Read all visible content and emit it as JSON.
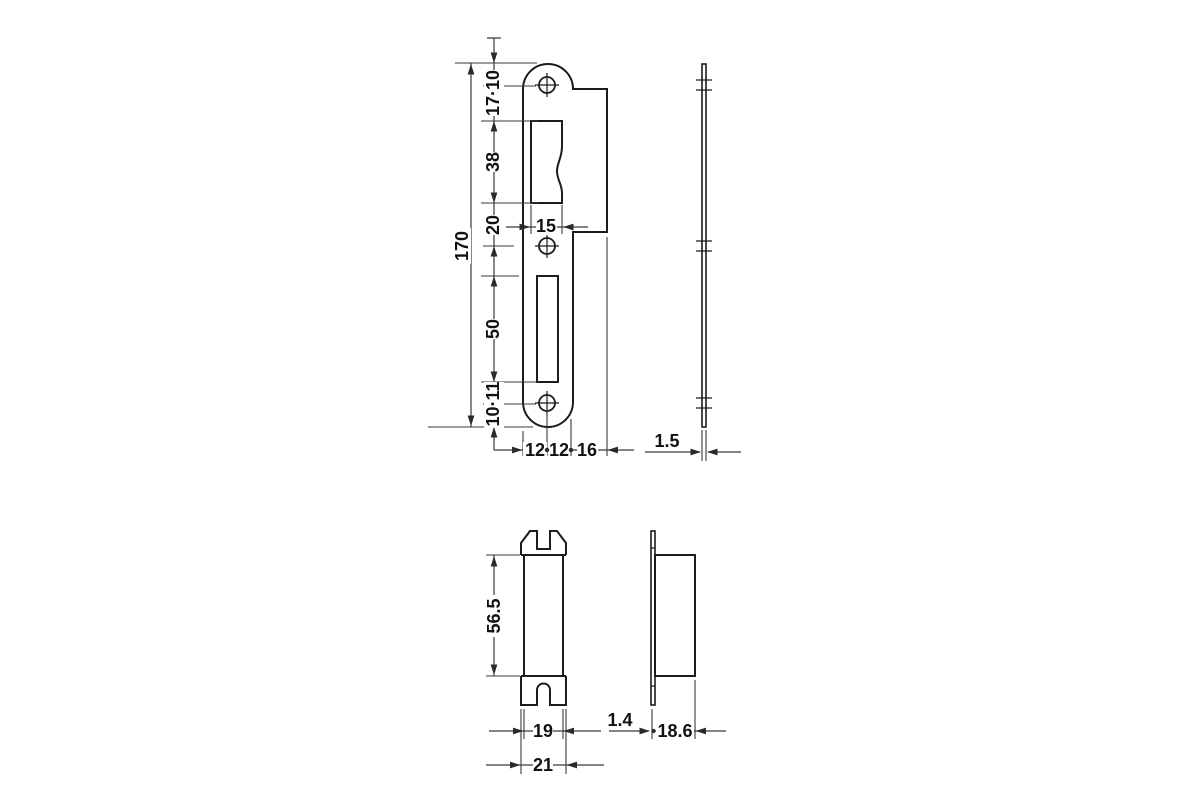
{
  "drawing_type": "technical-dimension-drawing",
  "colors": {
    "background": "#ffffff",
    "outline": "#1c1c1c",
    "dimension": "#3a3a3a",
    "text": "#111111"
  },
  "strike_plate_front": {
    "overall_length": "170",
    "top_segments": "17·10",
    "latch_opening_height": "38",
    "latch_bottom_to_hole": "20",
    "latch_opening_width": "15",
    "bolt_opening_height": "50",
    "bottom_segments": "10·11",
    "left_half_width": "12",
    "right_half_width": "12",
    "lip_width": "16"
  },
  "strike_plate_side": {
    "thickness": "1.5"
  },
  "dust_box_front": {
    "inner_height": "56.5",
    "body_width": "19",
    "flange_width": "21"
  },
  "dust_box_side": {
    "flange_thickness": "1.4",
    "depth": "18.6"
  }
}
